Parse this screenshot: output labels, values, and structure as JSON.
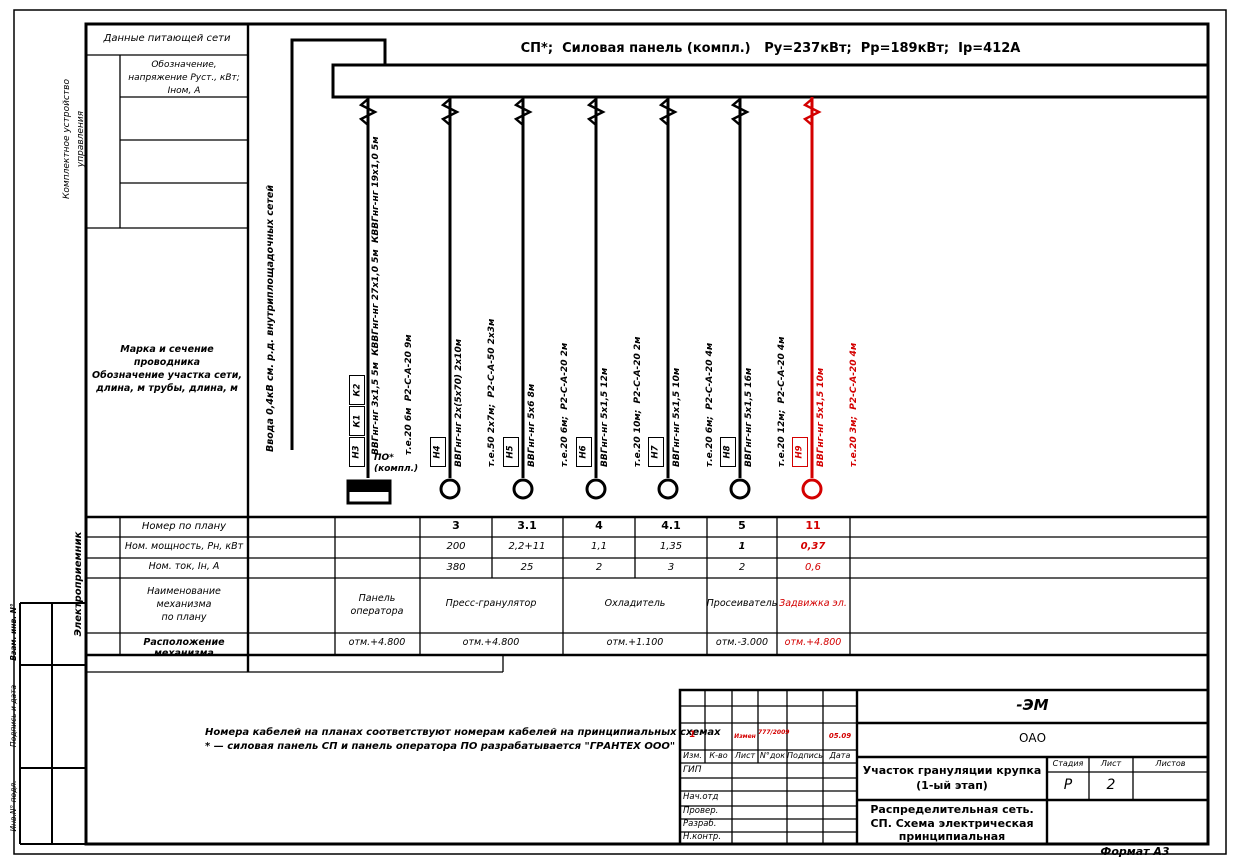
{
  "colors": {
    "red": "#d40000",
    "ink": "#000000"
  },
  "format_label": "Формат А3",
  "sidebar": {
    "boxes": [
      "Взам. инв. N°",
      "Подпись и дата",
      "Инв.N° подл."
    ]
  },
  "header_col": {
    "supply": "Данные питающей сети",
    "device": "Комплектное устройство управления",
    "designation": "Обозначение, напряжение Руст., кВт; Iном, А",
    "marka_l1": "Марка и сечение проводника",
    "marka_l2": "Обозначение участка сети,",
    "marka_l3": "длина, м трубы, длина, м"
  },
  "schematic": {
    "title": "СП*;  Силовая панель (компл.)   Ру=237кВт;  Рр=189кВт;  Iр=412А",
    "incoming": "Ввода 0,4кВ см. р.д. внутриплощадочных сетей",
    "po": {
      "tags": [
        "К2",
        "К1",
        "Н3"
      ],
      "cable": "ВВГнг-нг 3х1,5 5м  КВВГнг-нг 27х1,0 5м  КВВГнг-нг 19х1,0 5м",
      "route": "т.е.20 6м  Р2-С-А-20 9м",
      "device_line1": "ПО*",
      "device_line2": "(компл.)"
    },
    "feeders": [
      {
        "tag": "Н4",
        "cable": "ВВГнг-нг 2х(5х70) 2х10м",
        "route": "т.е.50 2х7м;  Р2-С-А-50 2х3м"
      },
      {
        "tag": "Н5",
        "cable": "ВВГнг-нг 5х6 8м",
        "route": "т.е.20 6м;  Р2-С-А-20 2м"
      },
      {
        "tag": "Н6",
        "cable": "ВВГнг-нг 5х1,5 12м",
        "route": "т.е.20 10м;  Р2-С-А-20 2м"
      },
      {
        "tag": "Н7",
        "cable": "ВВГнг-нг 5х1,5 10м",
        "route": "т.е.20 6м;  Р2-С-А-20 4м"
      },
      {
        "tag": "Н8",
        "cable": "ВВГнг-нг 5х1,5 16м",
        "route": "т.е.20 12м;  Р2-С-А-20 4м"
      },
      {
        "tag": "Н9",
        "cable": "ВВГнг-нг 5х1,5 10м",
        "route": "т.е.20 3м;  Р2-С-А-20 4м"
      }
    ]
  },
  "table": {
    "side_label": "Электроприемник",
    "rows": {
      "num": "Номер по плану",
      "power": "Ном. мощность, Рн, кВт",
      "current": "Ном. ток, Iн, А",
      "name_l1": "Наименование",
      "name_l2": "механизма",
      "name_l3": "по плану",
      "location": "Расположение механизма"
    },
    "nums": [
      "3",
      "3.1",
      "4",
      "4.1",
      "5",
      "11"
    ],
    "powers": [
      "200",
      "2,2+11",
      "1,1",
      "1,35",
      "1",
      "0,37"
    ],
    "currents": [
      "380",
      "25",
      "2",
      "3",
      "2",
      "0,6"
    ],
    "names": [
      "Панель оператора",
      "Пресс-гранулятор",
      "Охладитель",
      "Просеиватель",
      "Задвижка эл."
    ],
    "elevations": [
      "отм.+4.800",
      "отм.+4.800",
      "отм.+1.100",
      "отм.-3.000",
      "отм.+4.800"
    ]
  },
  "notes": {
    "line1": "Номера кабелей на планах соответствуют номерам кабелей на принципиальных схемах",
    "line2": "* — силовая панель СП и панель оператора ПО разрабатывается \"ГРАНТЕХ ООО\""
  },
  "title_block": {
    "code": "-ЭМ",
    "company": "ОАО",
    "rev_headers": [
      "Изм.",
      "К-во",
      "Лист",
      "N°док",
      "Подпись",
      "Дата"
    ],
    "revision": {
      "izm": "1",
      "list": "Измен",
      "doc": "777/2009",
      "date": "05.09"
    },
    "sign_labels": [
      "ГИП",
      "Нач.отд",
      "Провер.",
      "Разраб.",
      "Н.контр."
    ],
    "object_l1": "Участок грануляции крупка",
    "object_l2": "(1-ый этап)",
    "stage_headers": [
      "Стадия",
      "Лист",
      "Листов"
    ],
    "stage": "Р",
    "sheet": "2",
    "sheets": "",
    "doc_l1": "Распределительная сеть.",
    "doc_l2": "СП. Схема электрическая",
    "doc_l3": "принципиальная"
  }
}
